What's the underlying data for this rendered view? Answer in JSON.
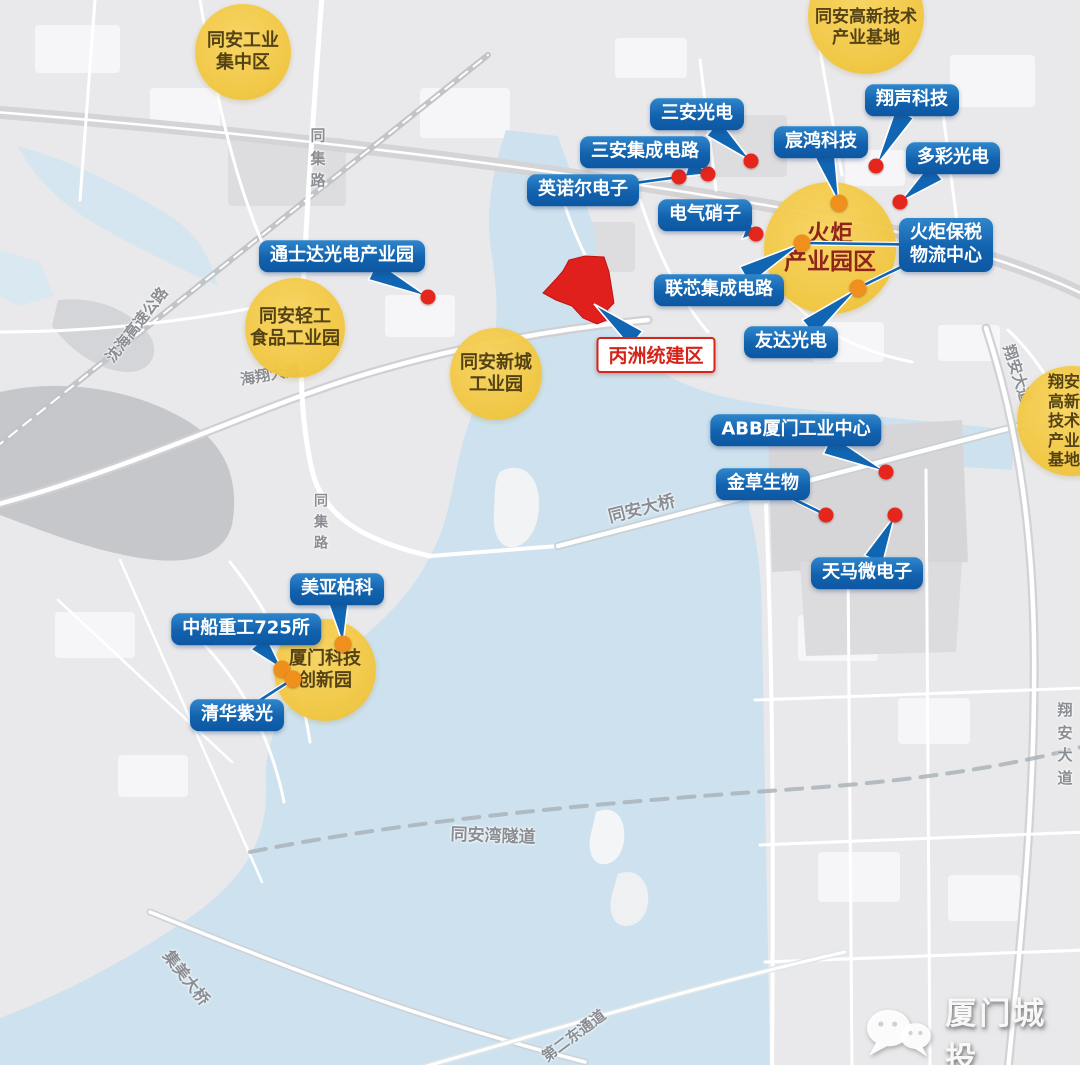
{
  "colors": {
    "label_blue": "#1166b3",
    "zone_yellow": "#f3c844",
    "dot_red": "#e5261d",
    "dot_orange": "#ef8f1c",
    "site_red": "#d5251a",
    "water": "#cde2ee",
    "land": "#e9e9eb"
  },
  "watermark": {
    "icon": "wechat-bubbles-icon",
    "text": "厦门城投"
  },
  "map": {
    "zones": [
      {
        "name": "zone-tongan-industrial-cluster",
        "lines": [
          "同安工业",
          "集中区"
        ],
        "x": 243,
        "y": 52,
        "r": 48,
        "font_size": 18
      },
      {
        "name": "zone-tongan-hitech-base",
        "lines": [
          "同安高新技术",
          "产业基地"
        ],
        "x": 866,
        "y": 16,
        "r": 58,
        "font_size": 17,
        "text_shift_y": 12
      },
      {
        "name": "zone-torch-industrial-park",
        "lines": [
          "火炬",
          "产业园区"
        ],
        "x": 830,
        "y": 248,
        "r": 66,
        "font_size": 23,
        "text_color": "#8b1a10"
      },
      {
        "name": "zone-tongan-light-food-park",
        "lines": [
          "同安轻工",
          "食品工业园"
        ],
        "x": 295,
        "y": 328,
        "r": 50,
        "font_size": 18
      },
      {
        "name": "zone-tongan-newtown-park",
        "lines": [
          "同安新城",
          "工业园"
        ],
        "x": 496,
        "y": 374,
        "r": 46,
        "font_size": 18
      },
      {
        "name": "zone-xiangan-hitech-base",
        "lines": [
          "翔安",
          "高新",
          "技术",
          "产业",
          "基地"
        ],
        "x": 1072,
        "y": 421,
        "r": 55,
        "font_size": 16,
        "text_shift_x": -8
      },
      {
        "name": "zone-xiamen-tech-innovation-park",
        "lines": [
          "厦门科技",
          "创新园"
        ],
        "x": 325,
        "y": 670,
        "r": 51,
        "font_size": 18
      }
    ],
    "company_labels": [
      {
        "name": "label-sanan-optoelectronics",
        "text": "三安光电",
        "x": 697,
        "y": 114,
        "targets": [
          {
            "x": 751,
            "y": 161,
            "type": "tail"
          }
        ]
      },
      {
        "name": "label-sanan-ic",
        "text": "三安集成电路",
        "x": 645,
        "y": 152,
        "targets": [
          {
            "x": 708,
            "y": 174,
            "type": "tail"
          }
        ]
      },
      {
        "name": "label-innor-electronics",
        "text": "英诺尔电子",
        "x": 583,
        "y": 190,
        "targets": [
          {
            "x": 679,
            "y": 177,
            "type": "line"
          }
        ]
      },
      {
        "name": "label-electric-glass",
        "text": "电气硝子",
        "x": 705,
        "y": 215,
        "targets": [
          {
            "x": 756,
            "y": 234,
            "type": "tail"
          }
        ]
      },
      {
        "name": "label-chenhong-tech",
        "text": "宸鸿科技",
        "x": 821,
        "y": 142,
        "targets": [
          {
            "x": 839,
            "y": 203,
            "type": "tail"
          }
        ]
      },
      {
        "name": "label-xiangsheng-tech",
        "text": "翔声科技",
        "x": 912,
        "y": 100,
        "targets": [
          {
            "x": 876,
            "y": 166,
            "type": "tail"
          }
        ]
      },
      {
        "name": "label-duocai-opto",
        "text": "多彩光电",
        "x": 953,
        "y": 158,
        "targets": [
          {
            "x": 900,
            "y": 202,
            "type": "tail"
          }
        ]
      },
      {
        "name": "label-torch-bonded-logistics",
        "text": "火炬保税\n物流中心",
        "x": 946,
        "y": 245,
        "targets": [
          {
            "x": 802,
            "y": 243,
            "type": "line"
          },
          {
            "x": 858,
            "y": 288,
            "type": "line"
          }
        ]
      },
      {
        "name": "label-tongshida-opto-park",
        "text": "通士达光电产业园",
        "x": 342,
        "y": 256,
        "targets": [
          {
            "x": 428,
            "y": 297,
            "type": "tail"
          }
        ]
      },
      {
        "name": "label-lianxin-ic",
        "text": "联芯集成电路",
        "x": 719,
        "y": 290,
        "targets": [
          {
            "x": 802,
            "y": 243,
            "type": "tail"
          }
        ]
      },
      {
        "name": "label-auo-optronics",
        "text": "友达光电",
        "x": 791,
        "y": 342,
        "targets": [
          {
            "x": 858,
            "y": 288,
            "type": "tail"
          }
        ]
      },
      {
        "name": "label-abb-xiamen-hub",
        "text": "ABB厦门工业中心",
        "x": 796,
        "y": 430,
        "targets": [
          {
            "x": 886,
            "y": 472,
            "type": "tail"
          }
        ]
      },
      {
        "name": "label-jincao-bio",
        "text": "金草生物",
        "x": 763,
        "y": 484,
        "targets": [
          {
            "x": 826,
            "y": 515,
            "type": "line"
          }
        ]
      },
      {
        "name": "label-tianma-micro",
        "text": "天马微电子",
        "x": 867,
        "y": 573,
        "targets": [
          {
            "x": 895,
            "y": 515,
            "type": "tail"
          }
        ]
      },
      {
        "name": "label-meiya-pico",
        "text": "美亚柏科",
        "x": 337,
        "y": 589,
        "targets": [
          {
            "x": 343,
            "y": 644,
            "type": "tail"
          }
        ]
      },
      {
        "name": "label-csic-725",
        "text": "中船重工725所",
        "x": 246,
        "y": 629,
        "targets": [
          {
            "x": 282,
            "y": 669,
            "type": "tail"
          }
        ]
      },
      {
        "name": "label-tsinghua-unigroup",
        "text": "清华紫光",
        "x": 237,
        "y": 715,
        "targets": [
          {
            "x": 293,
            "y": 679,
            "type": "line"
          }
        ]
      },
      {
        "name": "label-bingzhou-site",
        "text": "丙洲统建区",
        "x": 656,
        "y": 355,
        "style": "site",
        "targets": [
          {
            "x": 594,
            "y": 304,
            "type": "tail"
          }
        ]
      }
    ],
    "dots": [
      {
        "name": "dot-sanan-optoelectronics",
        "x": 751,
        "y": 161,
        "color": "red"
      },
      {
        "name": "dot-sanan-ic",
        "x": 708,
        "y": 174,
        "color": "red"
      },
      {
        "name": "dot-innor-electronics",
        "x": 679,
        "y": 177,
        "color": "red"
      },
      {
        "name": "dot-electric-glass",
        "x": 756,
        "y": 234,
        "color": "red"
      },
      {
        "name": "dot-xiangsheng-tech",
        "x": 876,
        "y": 166,
        "color": "red"
      },
      {
        "name": "dot-duocai-opto",
        "x": 900,
        "y": 202,
        "color": "red"
      },
      {
        "name": "dot-chenhong-tech",
        "x": 839,
        "y": 203,
        "color": "orange"
      },
      {
        "name": "dot-lianxin-ic",
        "x": 802,
        "y": 243,
        "color": "orange"
      },
      {
        "name": "dot-auo-optronics",
        "x": 858,
        "y": 288,
        "color": "orange"
      },
      {
        "name": "dot-tongshida",
        "x": 428,
        "y": 297,
        "color": "red"
      },
      {
        "name": "dot-abb-xiamen",
        "x": 886,
        "y": 472,
        "color": "red"
      },
      {
        "name": "dot-jincao-bio",
        "x": 826,
        "y": 515,
        "color": "red"
      },
      {
        "name": "dot-tianma-micro",
        "x": 895,
        "y": 515,
        "color": "red"
      },
      {
        "name": "dot-meiya-pico",
        "x": 343,
        "y": 644,
        "color": "orange"
      },
      {
        "name": "dot-csic-725",
        "x": 282,
        "y": 669,
        "color": "orange"
      },
      {
        "name": "dot-tsinghua-unigroup",
        "x": 293,
        "y": 679,
        "color": "orange"
      }
    ],
    "road_labels": [
      {
        "name": "road-label-tongji-road-top",
        "text": "同集路",
        "x": 318,
        "y": 158,
        "vertical": true,
        "font_size": 15
      },
      {
        "name": "road-label-shenhai-expressway",
        "text": "沈海高速公路",
        "x": 137,
        "y": 325,
        "rotate": -52,
        "font_size": 15
      },
      {
        "name": "road-label-haixiang-avenue",
        "text": "海翔大道",
        "x": 270,
        "y": 375,
        "rotate": -10,
        "font_size": 15
      },
      {
        "name": "road-label-tongji-road-lower",
        "text": "同集路",
        "x": 321,
        "y": 523,
        "vertical": true,
        "font_size": 14
      },
      {
        "name": "road-label-tongan-bridge",
        "text": "同安大桥",
        "x": 642,
        "y": 510,
        "rotate": -14,
        "font_size": 17
      },
      {
        "name": "road-label-tongan-bay-tunnel",
        "text": "同安湾隧道",
        "x": 493,
        "y": 837,
        "rotate": 2,
        "font_size": 17
      },
      {
        "name": "road-label-jimei-bridge",
        "text": "集美大桥",
        "x": 186,
        "y": 978,
        "rotate": 52,
        "font_size": 16
      },
      {
        "name": "road-label-second-east-corridor",
        "text": "第二东通道",
        "x": 574,
        "y": 1036,
        "rotate": -37,
        "font_size": 15
      },
      {
        "name": "road-label-xiangan-avenue-upper",
        "text": "翔安大道",
        "x": 1017,
        "y": 374,
        "rotate": 72,
        "font_size": 15
      },
      {
        "name": "road-label-xiangan-avenue-lower",
        "text": "翔安大道",
        "x": 1065,
        "y": 744,
        "vertical": true,
        "font_size": 15
      }
    ]
  }
}
